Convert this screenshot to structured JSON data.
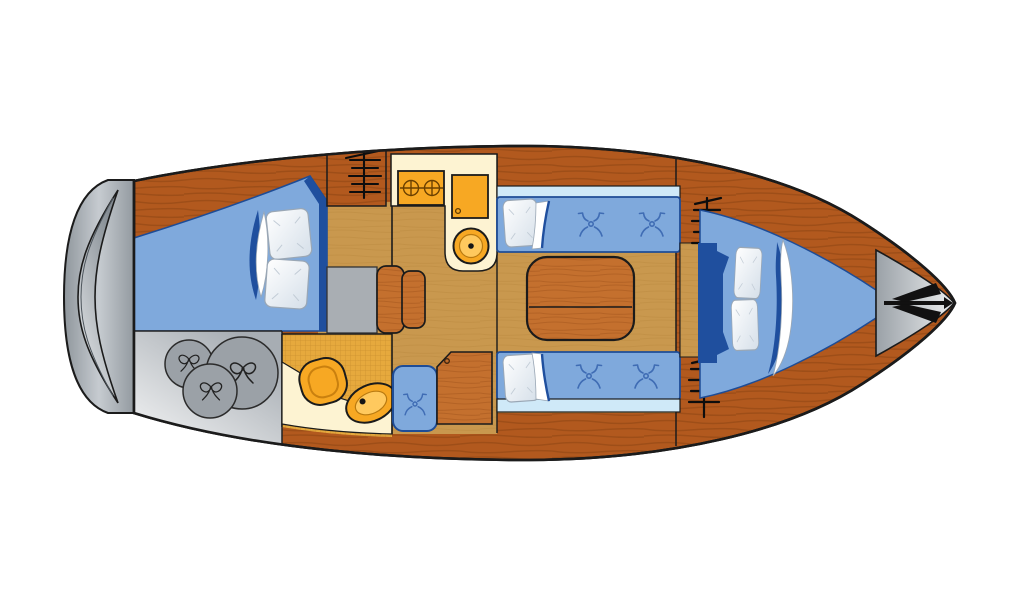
{
  "page": {
    "title": "sailing-yacht-interior-floor-plan",
    "background": "#ffffff"
  },
  "colors": {
    "bg": "#ffffff",
    "outline": "#1b1b1b",
    "wood": "#b2591e",
    "woodStreak": "#8a4312",
    "woodLight": "#c4702e",
    "woodLightStreak": "#9e531a",
    "floor": "#c9984e",
    "floorStreak": "#b3823a",
    "cushion": "#7fa9dc",
    "cushionDark": "#1f4f9e",
    "cushionEdge": "#1e4c96",
    "cushionPale": "#cfe9f8",
    "tuft": "#3f6cb4",
    "gray": "#9ba1a7",
    "grayDark": "#2b2b2b",
    "grayBox": "#a9aeb3",
    "cream": "#fdf3d2",
    "orange": "#f7a823",
    "orangeLight": "#ffc95e",
    "orangeLine": "#b97a10",
    "headFloor": "#e6a93d",
    "headGrid": "#cc9130",
    "pillowEdge": "#9aa7b5",
    "white": "#ffffff"
  },
  "diagram": {
    "type": "floorplan",
    "subject": "sailing-yacht-interior-top-view",
    "orientation": {
      "stern": "left",
      "bow": "right"
    },
    "regions": [
      {
        "id": "swim-platform"
      },
      {
        "id": "aft-cabin-double-berth"
      },
      {
        "id": "stern-storage-sail-bags"
      },
      {
        "id": "head-compartment"
      },
      {
        "id": "companionway-steps"
      },
      {
        "id": "galley"
      },
      {
        "id": "salon-settees-and-table"
      },
      {
        "id": "nav-seat-chart-table"
      },
      {
        "id": "forward-v-berth"
      },
      {
        "id": "bow-anchor-locker"
      }
    ],
    "icons": [
      "anchor-icon",
      "stove-burner-icon",
      "fridge-icon",
      "sink-icon",
      "toilet-icon",
      "ladder-icon",
      "hanging-locker-icon",
      "cushion-button-icon",
      "sail-bag-icon",
      "pillow",
      "blanket-fold"
    ],
    "counts": {
      "pillows": 6,
      "sail_bags": 3,
      "stove_burners": 2,
      "companionway_steps": 2,
      "cushion_buttons": 5,
      "hanging_locker_symbols": 2
    }
  }
}
